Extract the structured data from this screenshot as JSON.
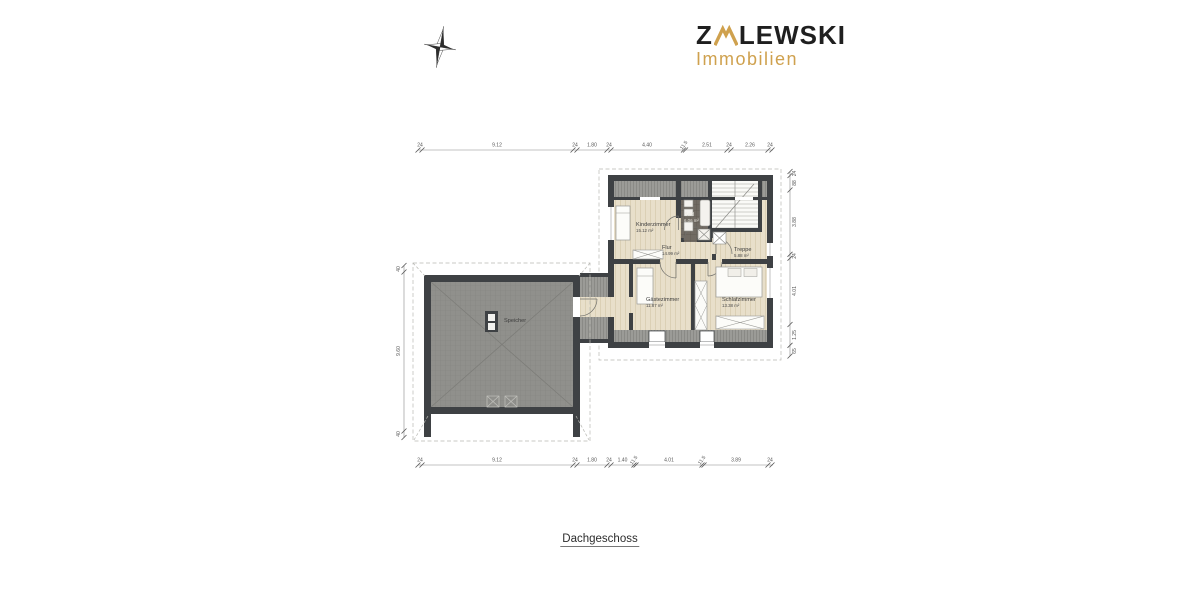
{
  "logo": {
    "part1": "Z",
    "part2": "LEWSKI",
    "subtitle": "Immobilien",
    "accent_color": "#CFA14E",
    "text_color": "#1f1f1f"
  },
  "title": "Dachgeschoss",
  "rooms": [
    {
      "name": "Kinderzimmer",
      "area": "15.12 m²"
    },
    {
      "name": "Bad",
      "area": "6.06 m²"
    },
    {
      "name": "Flur",
      "area": "14.99 m²"
    },
    {
      "name": "Treppe",
      "area": "5.88 m²"
    },
    {
      "name": "Gästezimmer",
      "area": "11.87 m²"
    },
    {
      "name": "Schlafzimmer",
      "area": "13.38 m²"
    },
    {
      "name": "Speicher",
      "area": ""
    }
  ],
  "dimensions": {
    "top": [
      "24",
      "9.12",
      "24",
      "1.80",
      "24",
      "4.40",
      "11.5",
      "2.51",
      "24",
      "2.26",
      "24"
    ],
    "bottom": [
      "24",
      "9.12",
      "24",
      "1.80",
      "24",
      "1.40",
      "11.5",
      "4.01",
      "11.5",
      "3.89",
      "24"
    ],
    "left": [
      "40",
      "9.60",
      "40"
    ],
    "right": [
      "24",
      "88",
      "3.88",
      "24",
      "4.01",
      "1.25",
      "65"
    ]
  },
  "colors": {
    "wall": "#3e4144",
    "wood_floor": "#e8dfca",
    "roof_hatch": "#9b9b97",
    "attic_fill": "#90908c",
    "bath_tile": "#716b63",
    "dashed_line": "#b8b8b3"
  }
}
